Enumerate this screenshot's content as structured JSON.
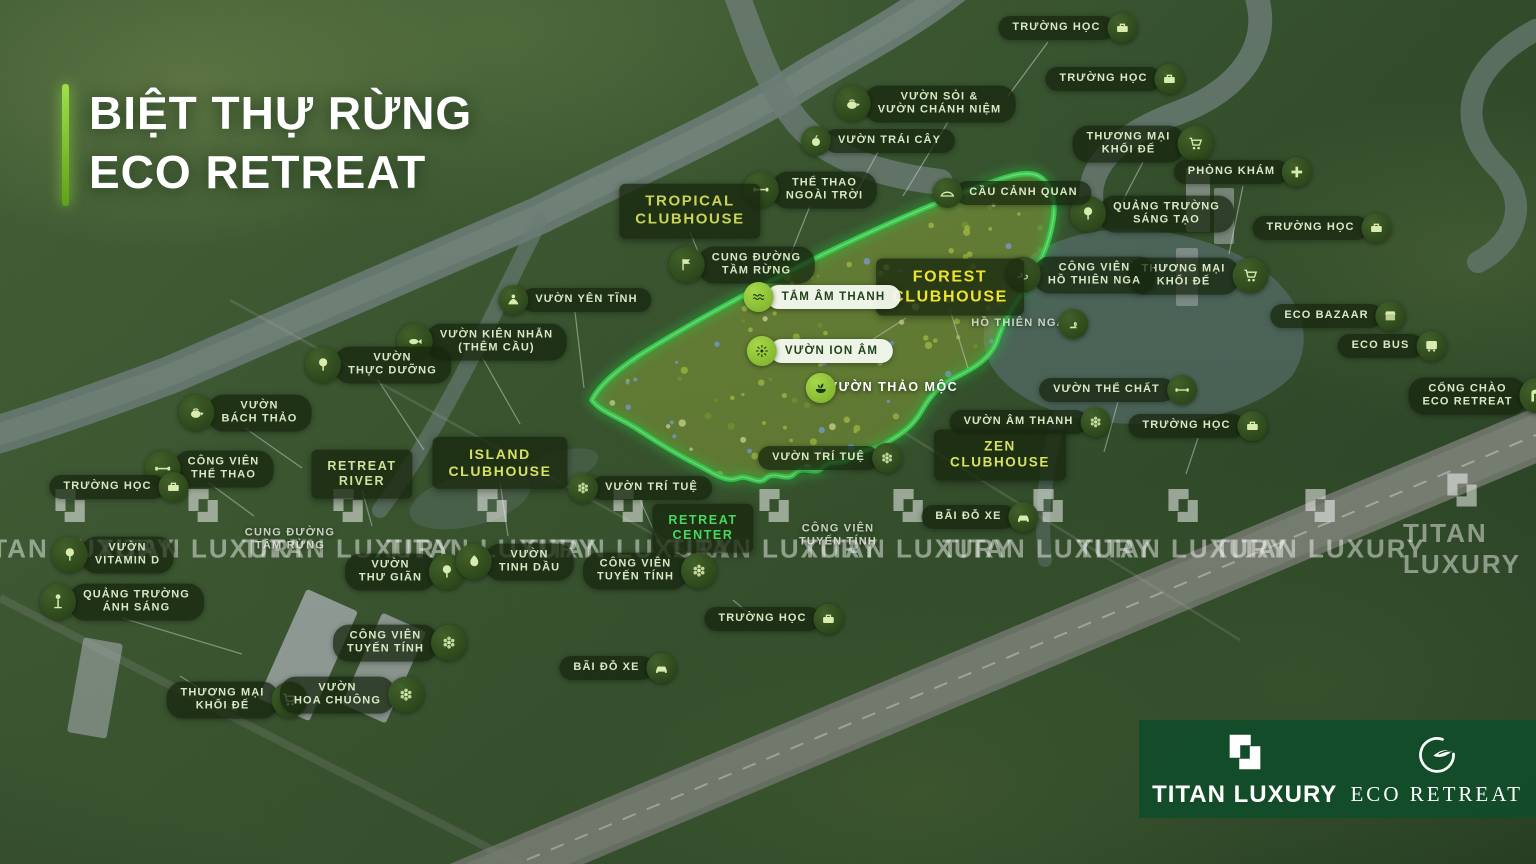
{
  "title": {
    "line1": "BIỆT THỰ RỪNG",
    "line2": "ECO RETREAT"
  },
  "colors": {
    "accent_green": "#7ed632",
    "zone_outline": "#3cf05a",
    "zone_fill": "#a9c742",
    "label_bg": "#16260e",
    "forest_label_text": "#f0e32e",
    "clubhouse_label_text": "#d8e063",
    "retreat_center_text": "#46d95b",
    "footer_bg": "#114c29",
    "river": "#7e908a"
  },
  "map": {
    "labels": [
      {
        "id": "truong-hoc-1",
        "lines": [
          "TRƯỜNG HỌC"
        ],
        "icon": "school",
        "side": "right",
        "style": "dark",
        "x": 1068,
        "y": 28
      },
      {
        "id": "truong-hoc-2",
        "lines": [
          "TRƯỜNG HỌC"
        ],
        "icon": "school",
        "side": "right",
        "style": "dark",
        "x": 1115,
        "y": 79
      },
      {
        "id": "vuon-soi-chanh-niem",
        "lines": [
          "VƯỜN SỎI &",
          "VƯỜN CHÁNH NIỆM"
        ],
        "icon": "teapot",
        "side": "left",
        "style": "dark",
        "x": 925,
        "y": 104
      },
      {
        "id": "vuon-trai-cay",
        "lines": [
          "VƯỜN TRÁI CÂY"
        ],
        "icon": "apple",
        "side": "left",
        "style": "dark",
        "x": 878,
        "y": 141
      },
      {
        "id": "thuong-mai-khoi-de-1",
        "lines": [
          "THƯƠNG MẠI",
          "KHỐI ĐẾ"
        ],
        "icon": "cart",
        "side": "right",
        "style": "dark",
        "x": 1143,
        "y": 144
      },
      {
        "id": "phong-kham",
        "lines": [
          "PHÒNG KHÁM"
        ],
        "icon": "plus",
        "side": "right",
        "style": "dark",
        "x": 1243,
        "y": 172
      },
      {
        "id": "the-thao-ngoai-troi",
        "lines": [
          "THỂ THAO",
          "NGOÀI TRỜI"
        ],
        "icon": "dumbbell",
        "side": "left",
        "style": "dark",
        "x": 810,
        "y": 190
      },
      {
        "id": "quang-truong-sang-tao",
        "lines": [
          "QUẢNG TRƯỜNG",
          "SÁNG TẠO"
        ],
        "icon": "tree",
        "side": "left",
        "style": "dark",
        "x": 1152,
        "y": 214
      },
      {
        "id": "truong-hoc-3",
        "lines": [
          "TRƯỜNG HỌC"
        ],
        "icon": "school",
        "side": "right",
        "style": "dark",
        "x": 1322,
        "y": 228
      },
      {
        "id": "cau-canh-quan",
        "lines": [
          "CẦU CẢNH QUAN"
        ],
        "icon": "bridge",
        "side": "left",
        "style": "dark",
        "x": 1012,
        "y": 193
      },
      {
        "id": "cung-duong-tam-rung-1",
        "lines": [
          "CUNG ĐƯỜNG",
          "TẦM RỪNG"
        ],
        "icon": "trail",
        "side": "left",
        "style": "dark",
        "x": 742,
        "y": 265
      },
      {
        "id": "tropical-clubhouse",
        "lines": [
          "TROPICAL",
          "CLUBHOUSE"
        ],
        "style": "box",
        "color": "#c9d455",
        "fs": 15,
        "x": 690,
        "y": 211
      },
      {
        "id": "vuon-yen-tinh",
        "lines": [
          "VƯỜN YÊN TĨNH"
        ],
        "icon": "meditate",
        "side": "left",
        "style": "dark",
        "x": 575,
        "y": 300
      },
      {
        "id": "thuong-mai-khoi-de-2",
        "lines": [
          "THƯƠNG MẠI",
          "KHỐI ĐẾ"
        ],
        "icon": "cart",
        "side": "right",
        "style": "dark",
        "x": 1198,
        "y": 276
      },
      {
        "id": "cong-vien-ho-thien-nga",
        "lines": [
          "CÔNG VIÊN",
          "HỒ THIÊN NGA"
        ],
        "icon": "swans",
        "side": "left",
        "style": "dark",
        "x": 1080,
        "y": 275
      },
      {
        "id": "forest-clubhouse",
        "lines": [
          "FOREST",
          "CLUBHOUSE"
        ],
        "style": "box",
        "color": "#f0e32e",
        "fs": 16,
        "x": 950,
        "y": 287
      },
      {
        "id": "tam-am-thanh",
        "lines": [
          "TẮM ÂM THANH"
        ],
        "icon": "wave",
        "side": "left",
        "style": "white",
        "x": 822,
        "y": 297
      },
      {
        "id": "vuon-kien-nhan",
        "lines": [
          "VƯỜN KIÊN NHẪN",
          "(THÊM CẦU)"
        ],
        "icon": "fish",
        "side": "left",
        "style": "dark",
        "x": 482,
        "y": 342
      },
      {
        "id": "ho-thien-nga",
        "lines": [
          "HỒ THIÊN NGA"
        ],
        "icon": "swan",
        "side": "right",
        "style": "faint",
        "x": 1030,
        "y": 324
      },
      {
        "id": "eco-bazaar",
        "lines": [
          "ECO BAZAAR"
        ],
        "icon": "store",
        "side": "right",
        "style": "dark",
        "x": 1338,
        "y": 316
      },
      {
        "id": "vuon-ion-am",
        "lines": [
          "VƯỜN ION ÂM"
        ],
        "icon": "ion",
        "side": "left",
        "style": "white",
        "x": 820,
        "y": 351
      },
      {
        "id": "vuon-thuc-duong",
        "lines": [
          "VƯỜN",
          "THỰC DƯỠNG"
        ],
        "icon": "tree",
        "side": "left",
        "style": "dark",
        "x": 378,
        "y": 365
      },
      {
        "id": "eco-bus",
        "lines": [
          "ECO BUS"
        ],
        "icon": "bus",
        "side": "right",
        "style": "dark",
        "x": 1392,
        "y": 346
      },
      {
        "id": "vuon-thao-moc",
        "lines": [
          "VƯỜN THẢO MỘC"
        ],
        "icon": "herb",
        "side": "left",
        "style": "plainwhite",
        "x": 882,
        "y": 388
      },
      {
        "id": "vuon-bach-thao",
        "lines": [
          "VƯỜN",
          "BÁCH THẢO"
        ],
        "icon": "teapot",
        "side": "left",
        "style": "dark",
        "x": 245,
        "y": 413
      },
      {
        "id": "cong-chao-eco-retreat",
        "lines": [
          "CỔNG CHÀO",
          "ECO RETREAT"
        ],
        "icon": "gate",
        "side": "right",
        "style": "dark",
        "x": 1482,
        "y": 396
      },
      {
        "id": "vuon-the-chat",
        "lines": [
          "VƯỜN THỂ CHẤT"
        ],
        "icon": "dumbbell",
        "side": "right",
        "style": "dark",
        "x": 1118,
        "y": 390
      },
      {
        "id": "vuon-am-thanh",
        "lines": [
          "VƯỜN ÂM THANH"
        ],
        "icon": "flower",
        "side": "right",
        "style": "dark",
        "x": 1030,
        "y": 422
      },
      {
        "id": "truong-hoc-4",
        "lines": [
          "TRƯỜNG HỌC"
        ],
        "icon": "school",
        "side": "right",
        "style": "dark",
        "x": 1198,
        "y": 426
      },
      {
        "id": "zen-clubhouse",
        "lines": [
          "ZEN",
          "CLUBHOUSE"
        ],
        "style": "box",
        "color": "#d8e063",
        "fs": 13.5,
        "x": 1000,
        "y": 455
      },
      {
        "id": "vuon-tri-tue-1",
        "lines": [
          "VƯỜN TRÍ TUỆ"
        ],
        "icon": "flower",
        "side": "right",
        "style": "dark",
        "x": 830,
        "y": 458
      },
      {
        "id": "island-clubhouse",
        "lines": [
          "ISLAND",
          "CLUBHOUSE"
        ],
        "style": "box",
        "color": "#d8e063",
        "fs": 14,
        "x": 500,
        "y": 463
      },
      {
        "id": "vuon-tri-tue-2",
        "lines": [
          "VƯỜN TRÍ TUỆ"
        ],
        "icon": "flower",
        "side": "left",
        "style": "dark",
        "x": 640,
        "y": 488
      },
      {
        "id": "cong-vien-the-thao",
        "lines": [
          "CÔNG VIÊN",
          "THỂ THAO"
        ],
        "icon": "dumbbell",
        "side": "left",
        "style": "dark",
        "x": 209,
        "y": 469
      },
      {
        "id": "truong-hoc-5",
        "lines": [
          "TRƯỜNG HỌC"
        ],
        "icon": "school",
        "side": "right",
        "style": "dark",
        "x": 119,
        "y": 487
      },
      {
        "id": "retreat-river",
        "lines": [
          "RETREAT",
          "RIVER"
        ],
        "style": "box",
        "color": "#cfe0a0",
        "fs": 12.5,
        "x": 362,
        "y": 474
      },
      {
        "id": "bai-do-xe-1",
        "lines": [
          "BÃI ĐỖ XE"
        ],
        "icon": "car",
        "side": "right",
        "style": "dark",
        "x": 980,
        "y": 517
      },
      {
        "id": "retreat-center",
        "lines": [
          "RETREAT",
          "CENTER"
        ],
        "style": "box",
        "color": "#46d95b",
        "fs": 12.5,
        "x": 703,
        "y": 528
      },
      {
        "id": "cong-vien-tuyen-tinh-1",
        "lines": [
          "CÔNG VIÊN",
          "TUYẾN TÍNH"
        ],
        "style": "faint",
        "x": 838,
        "y": 536
      },
      {
        "id": "cung-duong-tam-rung-2",
        "lines": [
          "CUNG ĐƯỜNG",
          "TẦM RỪNG"
        ],
        "style": "faint",
        "x": 290,
        "y": 540
      },
      {
        "id": "vuon-vitamin-d",
        "lines": [
          "VƯỜN",
          "VITAMIN D"
        ],
        "icon": "tree",
        "side": "left",
        "style": "dark",
        "x": 113,
        "y": 555
      },
      {
        "id": "vuon-thu-gian",
        "lines": [
          "VƯỜN",
          "THƯ GIÃN"
        ],
        "icon": "tree",
        "side": "right",
        "style": "dark",
        "x": 405,
        "y": 572
      },
      {
        "id": "vuon-tinh-dau",
        "lines": [
          "VƯỜN",
          "TINH DẦU"
        ],
        "icon": "leaf",
        "side": "left",
        "style": "dark",
        "x": 515,
        "y": 562
      },
      {
        "id": "cong-vien-tuyen-tinh-2",
        "lines": [
          "CÔNG VIÊN",
          "TUYẾN TÍNH"
        ],
        "icon": "flower",
        "side": "right",
        "style": "dark",
        "x": 650,
        "y": 571
      },
      {
        "id": "quang-truong-anh-sang",
        "lines": [
          "QUẢNG TRƯỜNG",
          "ÁNH SÁNG"
        ],
        "icon": "lamp",
        "side": "left",
        "style": "dark",
        "x": 122,
        "y": 602
      },
      {
        "id": "truong-hoc-6",
        "lines": [
          "TRƯỜNG HỌC"
        ],
        "icon": "school",
        "side": "right",
        "style": "dark",
        "x": 774,
        "y": 619
      },
      {
        "id": "cong-vien-tuyen-tinh-3",
        "lines": [
          "CÔNG VIÊN",
          "TUYẾN TÍNH"
        ],
        "icon": "flower",
        "side": "right",
        "style": "dark",
        "x": 400,
        "y": 643
      },
      {
        "id": "bai-do-xe-2",
        "lines": [
          "BÃI ĐỖ XE"
        ],
        "icon": "car",
        "side": "right",
        "style": "dark",
        "x": 618,
        "y": 668
      },
      {
        "id": "thuong-mai-khoi-de-3",
        "lines": [
          "THƯƠNG MẠI",
          "KHỐI ĐẾ"
        ],
        "icon": "cart",
        "side": "right",
        "style": "dark",
        "x": 237,
        "y": 700
      },
      {
        "id": "vuon-hoa-chuong",
        "lines": [
          "VƯỜN",
          "HOA CHUÔNG"
        ],
        "icon": "flower",
        "side": "right",
        "style": "dark",
        "x": 352,
        "y": 695
      }
    ]
  },
  "watermark": {
    "text": "TITAN LUXURY",
    "positions": [
      {
        "x": 70,
        "y": 524
      },
      {
        "x": 203,
        "y": 524
      },
      {
        "x": 348,
        "y": 524
      },
      {
        "x": 492,
        "y": 524
      },
      {
        "x": 628,
        "y": 524
      },
      {
        "x": 774,
        "y": 524
      },
      {
        "x": 908,
        "y": 524
      },
      {
        "x": 1048,
        "y": 524
      },
      {
        "x": 1183,
        "y": 524
      },
      {
        "x": 1320,
        "y": 524
      },
      {
        "x": 1462,
        "y": 524
      }
    ]
  },
  "footer": {
    "brand_primary": "TITAN LUXURY",
    "brand_secondary": "ECO RETREAT"
  }
}
